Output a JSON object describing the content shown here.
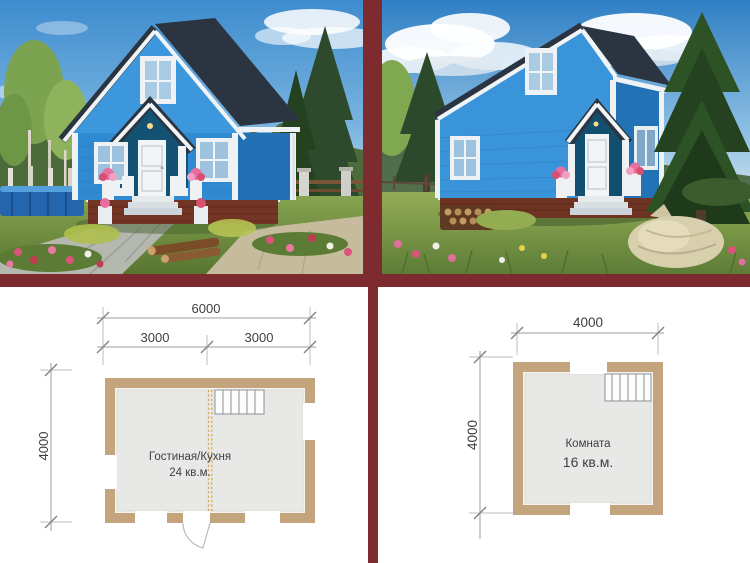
{
  "theme": {
    "frame_color": "#7d2b2e",
    "background_color": "#ffffff",
    "house_siding_color": "#2f8ad2",
    "roof_color": "#2b3542",
    "plan_wall_color": "#c4a47c",
    "plan_floor_color": "#e8e9e6",
    "plan_partition_dash_color": "#d8a855",
    "dimension_line_color": "#9aa0a4",
    "dimension_text_color": "#3d4043"
  },
  "photos": {
    "left": {
      "description": "Blue gable cottage with white trim, front view, garden, blue pool and paved path"
    },
    "right": {
      "description": "Blue gable cottage with white trim, angled view, pine trees, meadow and beige sack"
    }
  },
  "floor_plans": {
    "first": {
      "width_total": "6000",
      "width_left": "3000",
      "width_right": "3000",
      "depth": "4000",
      "room_label": "Гостиная/Кухня",
      "room_area": "24 кв.м."
    },
    "second": {
      "width_total": "4000",
      "depth": "4000",
      "room_label": "Комната",
      "room_area": "16 кв.м."
    }
  }
}
